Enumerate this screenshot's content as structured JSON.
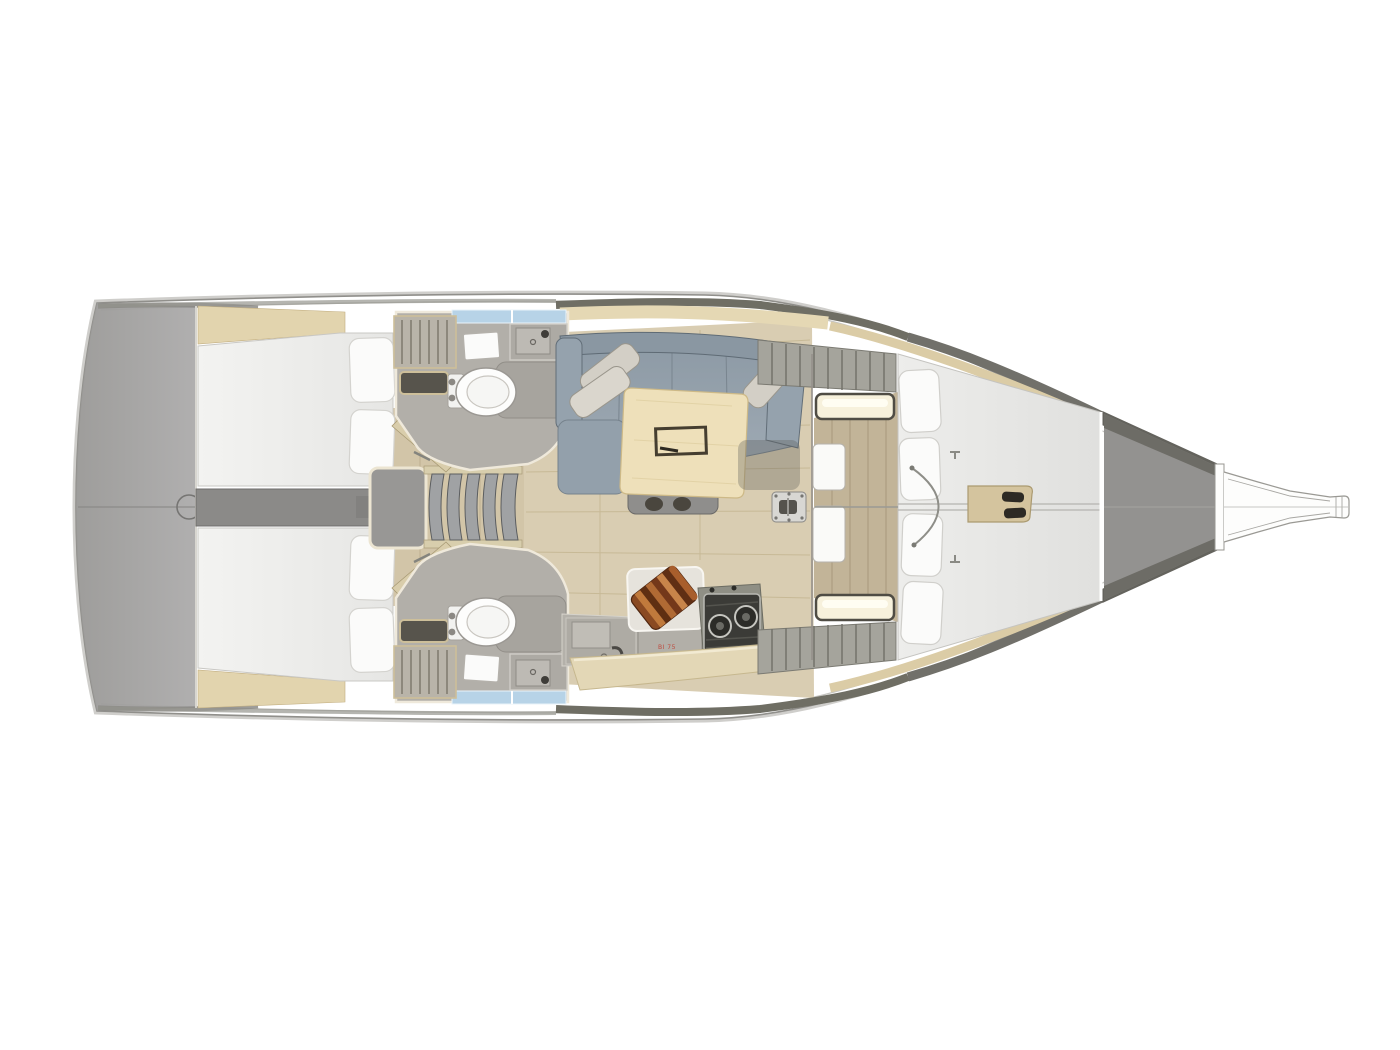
{
  "diagram": {
    "title": "sailboat-interior-floor-plan",
    "type": "yacht deck / accommodation plan, top-down view, bow pointing right",
    "labels": {
      "fridge_label": "BI 75"
    },
    "colors": {
      "background": "#ffffff",
      "hull_outline": "#908f8b",
      "transom_gray": "#a3a2a0",
      "foredeck_gray": "#939290",
      "sheer_band_dark": "#6f6e64",
      "shelf_tan": "#e5d8b4",
      "floor_wood": "#d9cdb2",
      "forward_floor_wood": "#c2b498",
      "mattress_white": "#f1f1ef",
      "sofa_gray_blue": "#99a6b0",
      "pillow_warm_gray": "#d3cfc6",
      "table_wood": "#eee0ba",
      "head_floor": "#b2afa9",
      "shower_glass_blue": "#b7d3e7",
      "stove_dark": "#3b3b37",
      "cutting_board_brown": "#8a4a22",
      "locker_light_glow": "#f7f1dc",
      "label_red": "#c0392b"
    },
    "regions": [
      {
        "name": "swim-platform-transom",
        "description": "gray rounded transom / stern platform at far left with rudder-post circle on centerline"
      },
      {
        "name": "port-aft-cabin",
        "description": "upper-left cabin, white double berth with two pillows at inboard end"
      },
      {
        "name": "starboard-aft-cabin",
        "description": "lower-left cabin, white double berth with two pillows at inboard end"
      },
      {
        "name": "engine-compartment",
        "description": "gray center spine and engine box between the aft cabins"
      },
      {
        "name": "companionway-stairs",
        "description": "five curved gray steps on centerline leading into the saloon"
      },
      {
        "name": "port-head",
        "description": "upper bathroom with toilet, mirror, sink and shower, blue glass strip outboard"
      },
      {
        "name": "starboard-head",
        "description": "lower bathroom with toilet, mirror, sink and shower, blue glass strip outboard, slatted bench"
      },
      {
        "name": "saloon",
        "description": "central living area with wood plank flooring"
      },
      {
        "name": "saloon-sofa",
        "description": "U-shaped gray-blue settee on port side with two angled pillows"
      },
      {
        "name": "saloon-table",
        "description": "light wood table with dark inset hatch and pedestal with two feet"
      },
      {
        "name": "mast-step-plate",
        "description": "small metal plate with bolts and shackle on saloon floor"
      },
      {
        "name": "galley",
        "description": "starboard-aft counter with sink, faucet, fridge, two-burner stove and striped cutting board"
      },
      {
        "name": "wardrobe-lockers",
        "description": "ribbed hanging lockers with glowing shelf lights at saloon / forward-cabin bulkhead"
      },
      {
        "name": "forward-cabin",
        "description": "V-berth with white mattress, four pillows, center seam, wood dressing floor and tan console with handles"
      },
      {
        "name": "anchor-locker-foredeck",
        "description": "gray tapering bow compartment forward of the berth"
      },
      {
        "name": "bowsprit",
        "description": "outlined bowsprit / sprit tube extending to the bow tip at far right"
      }
    ]
  }
}
